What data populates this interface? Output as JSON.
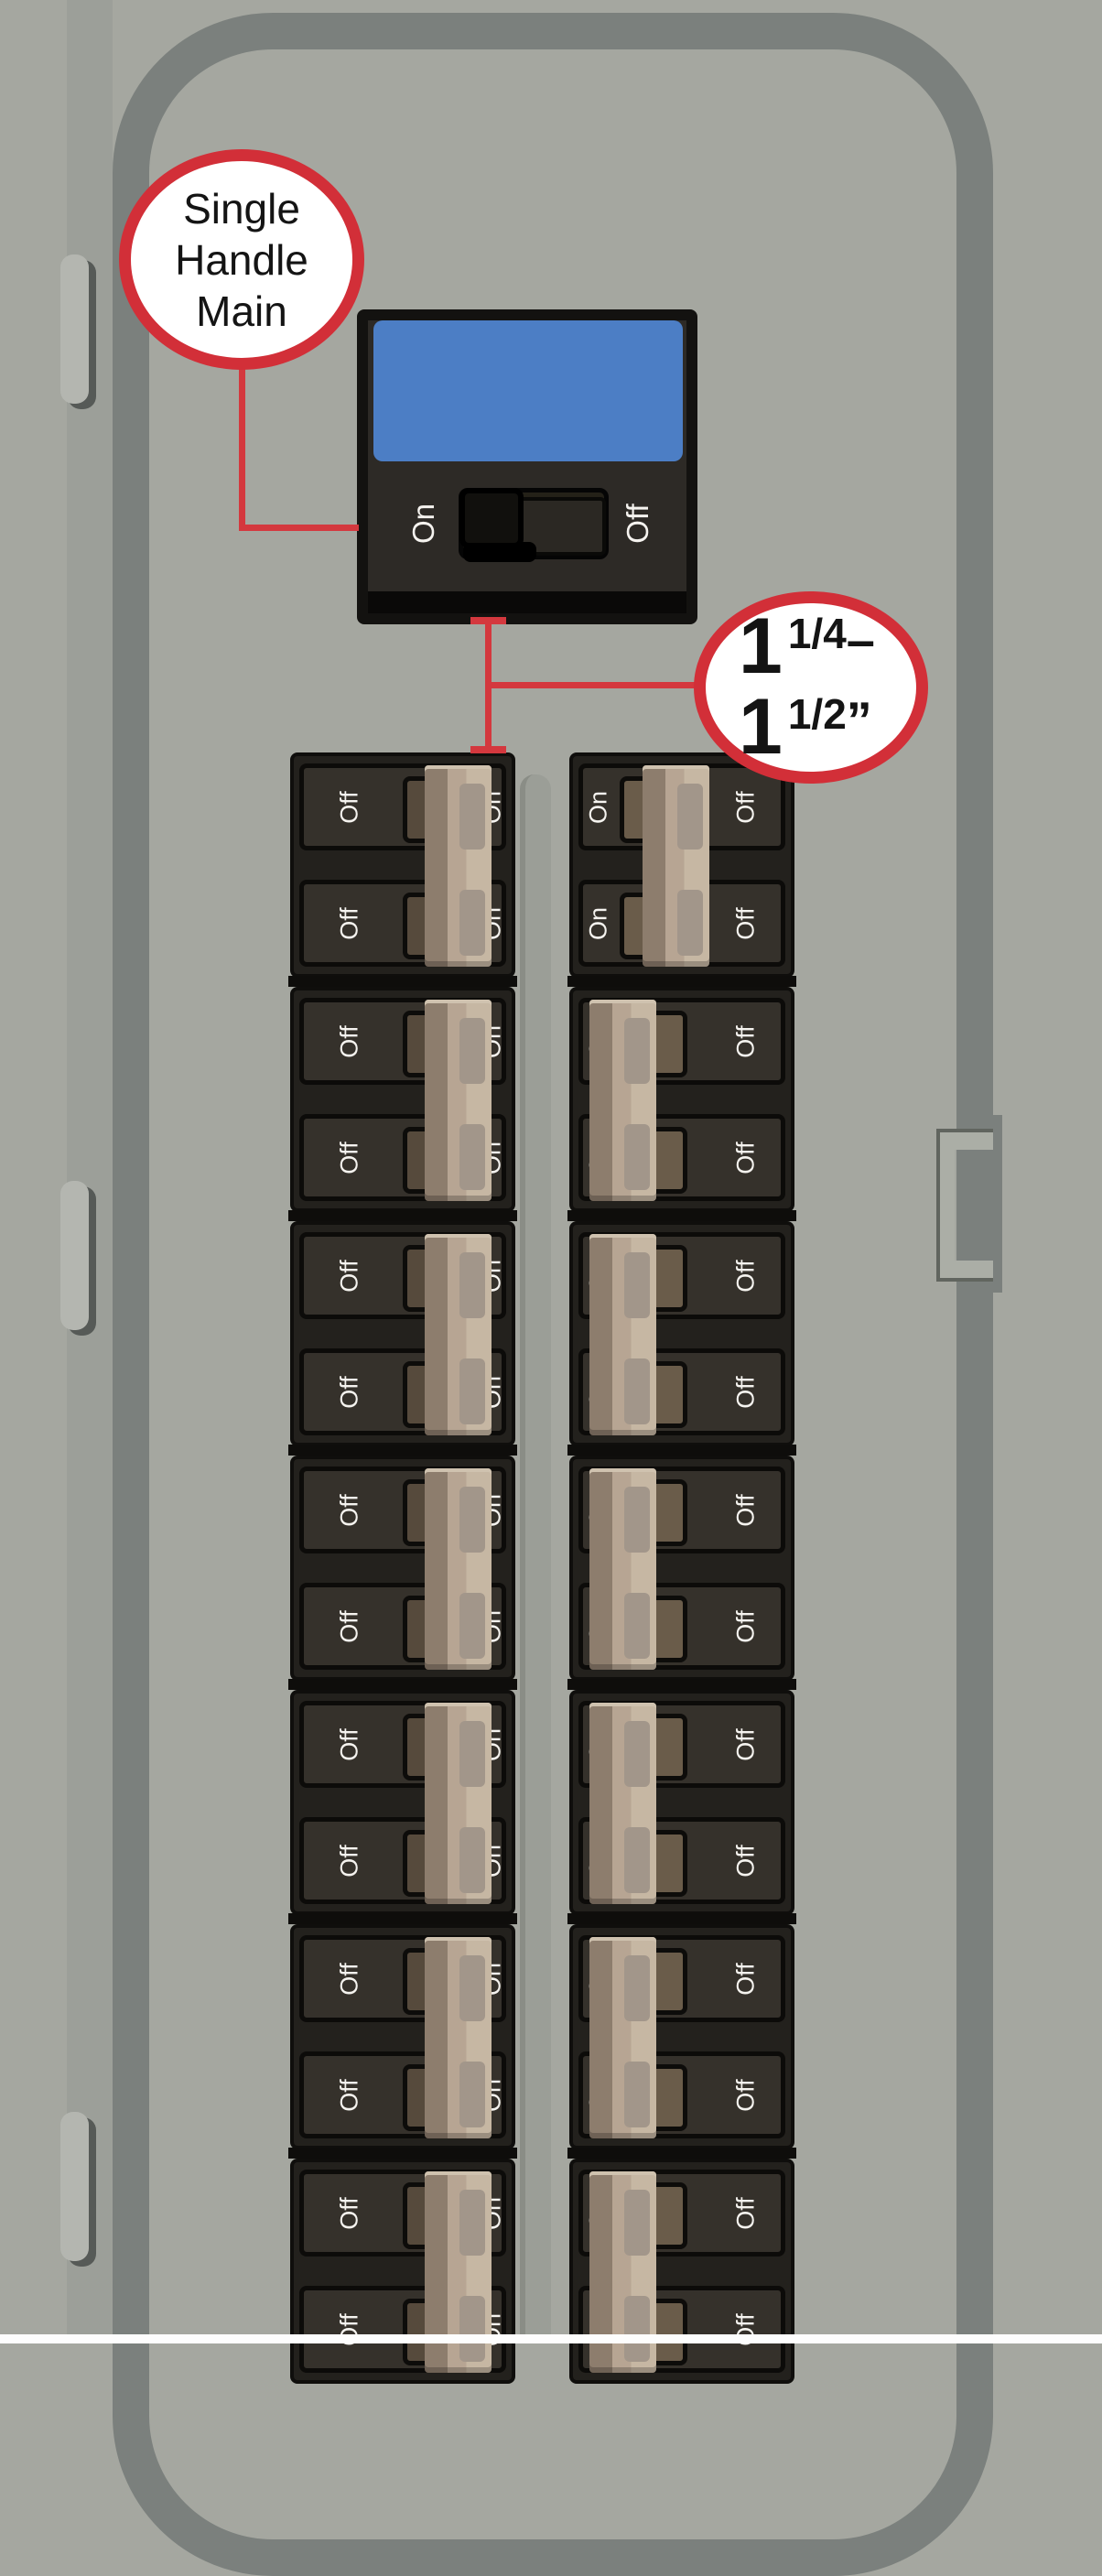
{
  "colors": {
    "panel_gray": "#a5a7a0",
    "frame_gray": "#7b807d",
    "accent_red": "#d22f38",
    "label_blue": "#4c7ec5",
    "handle_tan": "#b7a593"
  },
  "callout_main_handle": {
    "lines": [
      "Single",
      "Handle",
      "Main"
    ]
  },
  "callout_measurement": {
    "line1": {
      "value": "1",
      "fraction": "1/4",
      "suffix": "–"
    },
    "line2": {
      "value": "1",
      "fraction": "1/2",
      "suffix": "”"
    }
  },
  "main_breaker": {
    "on_label": "On",
    "off_label": "Off"
  },
  "breakers": {
    "left_column": {
      "units": [
        {
          "handle_side": "right",
          "rows": [
            {
              "left_label": "Off",
              "right_label": "On"
            },
            {
              "left_label": "Off",
              "right_label": "On"
            }
          ]
        },
        {
          "handle_side": "right",
          "rows": [
            {
              "left_label": "Off",
              "right_label": "On"
            },
            {
              "left_label": "Off",
              "right_label": "On"
            }
          ]
        },
        {
          "handle_side": "right",
          "rows": [
            {
              "left_label": "Off",
              "right_label": "On"
            },
            {
              "left_label": "Off",
              "right_label": "On"
            }
          ]
        },
        {
          "handle_side": "right",
          "rows": [
            {
              "left_label": "Off",
              "right_label": "On"
            },
            {
              "left_label": "Off",
              "right_label": "On"
            }
          ]
        },
        {
          "handle_side": "right",
          "rows": [
            {
              "left_label": "Off",
              "right_label": "On"
            },
            {
              "left_label": "Off",
              "right_label": "On"
            }
          ]
        },
        {
          "handle_side": "right",
          "rows": [
            {
              "left_label": "Off",
              "right_label": "On"
            },
            {
              "left_label": "Off",
              "right_label": "On"
            }
          ]
        },
        {
          "handle_side": "right",
          "rows": [
            {
              "left_label": "Off",
              "right_label": "On"
            },
            {
              "left_label": "Off",
              "right_label": "On"
            }
          ]
        }
      ]
    },
    "right_column": {
      "units": [
        {
          "handle_side": "center",
          "rows": [
            {
              "left_label": "On",
              "right_label": "Off"
            },
            {
              "left_label": "On",
              "right_label": "Off"
            }
          ]
        },
        {
          "handle_side": "left",
          "rows": [
            {
              "left_label": "On",
              "right_label": "Off"
            },
            {
              "left_label": "On",
              "right_label": "Off"
            }
          ]
        },
        {
          "handle_side": "left",
          "rows": [
            {
              "left_label": "On",
              "right_label": "Off"
            },
            {
              "left_label": "On",
              "right_label": "Off"
            }
          ]
        },
        {
          "handle_side": "left",
          "rows": [
            {
              "left_label": "On",
              "right_label": "Off"
            },
            {
              "left_label": "On",
              "right_label": "Off"
            }
          ]
        },
        {
          "handle_side": "left",
          "rows": [
            {
              "left_label": "On",
              "right_label": "Off"
            },
            {
              "left_label": "On",
              "right_label": "Off"
            }
          ]
        },
        {
          "handle_side": "left",
          "rows": [
            {
              "left_label": "On",
              "right_label": "Off"
            },
            {
              "left_label": "On",
              "right_label": "Off"
            }
          ]
        },
        {
          "handle_side": "left",
          "rows": [
            {
              "left_label": "On",
              "right_label": "Off"
            },
            {
              "left_label": "On",
              "right_label": "Off"
            }
          ]
        }
      ]
    }
  }
}
